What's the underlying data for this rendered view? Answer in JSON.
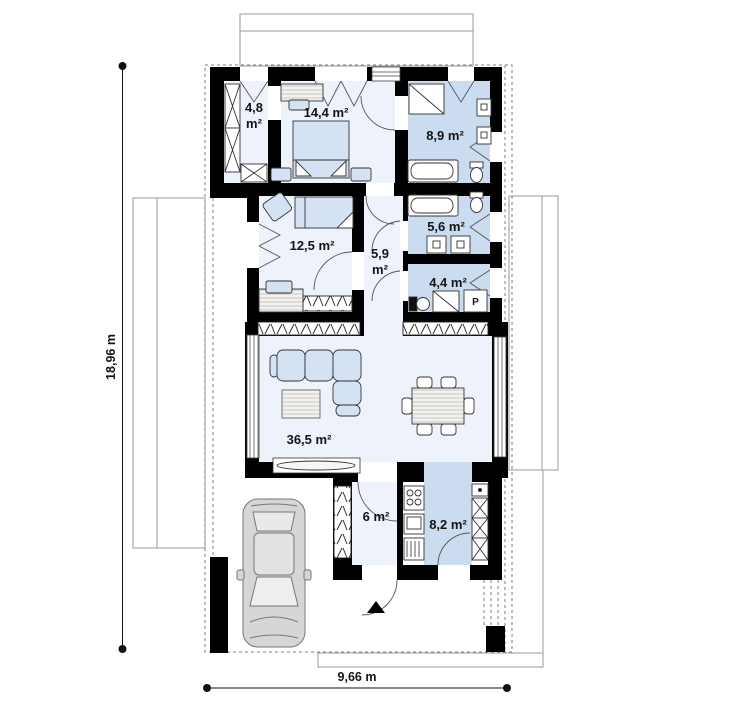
{
  "plan": {
    "type": "floor-plan",
    "rooms": {
      "wardrobe": {
        "area": "4,8",
        "unit": "m²"
      },
      "bedroom_large": {
        "label": "14,4 m²"
      },
      "bathroom_top": {
        "label": "8,9 m²"
      },
      "bedroom_small": {
        "label": "12,5 m²"
      },
      "corridor": {
        "area": "5,9",
        "unit": "m²"
      },
      "bathroom_mid": {
        "label": "5,6 m²"
      },
      "utility": {
        "label": "4,4 m²"
      },
      "living_room": {
        "label": "36,5 m²"
      },
      "hall": {
        "label": "6 m²"
      },
      "kitchen": {
        "label": "8,2 m²"
      }
    },
    "appliances": {
      "washer": "P"
    },
    "dimensions": {
      "vertical": "18,96 m",
      "horizontal": "9,66 m"
    },
    "colors": {
      "wall": "#000000",
      "floor_light": "#edf2fb",
      "floor_blue": "#cbdcf1",
      "furniture": "#d4e2f4",
      "outline": "#9a9a9a"
    }
  }
}
